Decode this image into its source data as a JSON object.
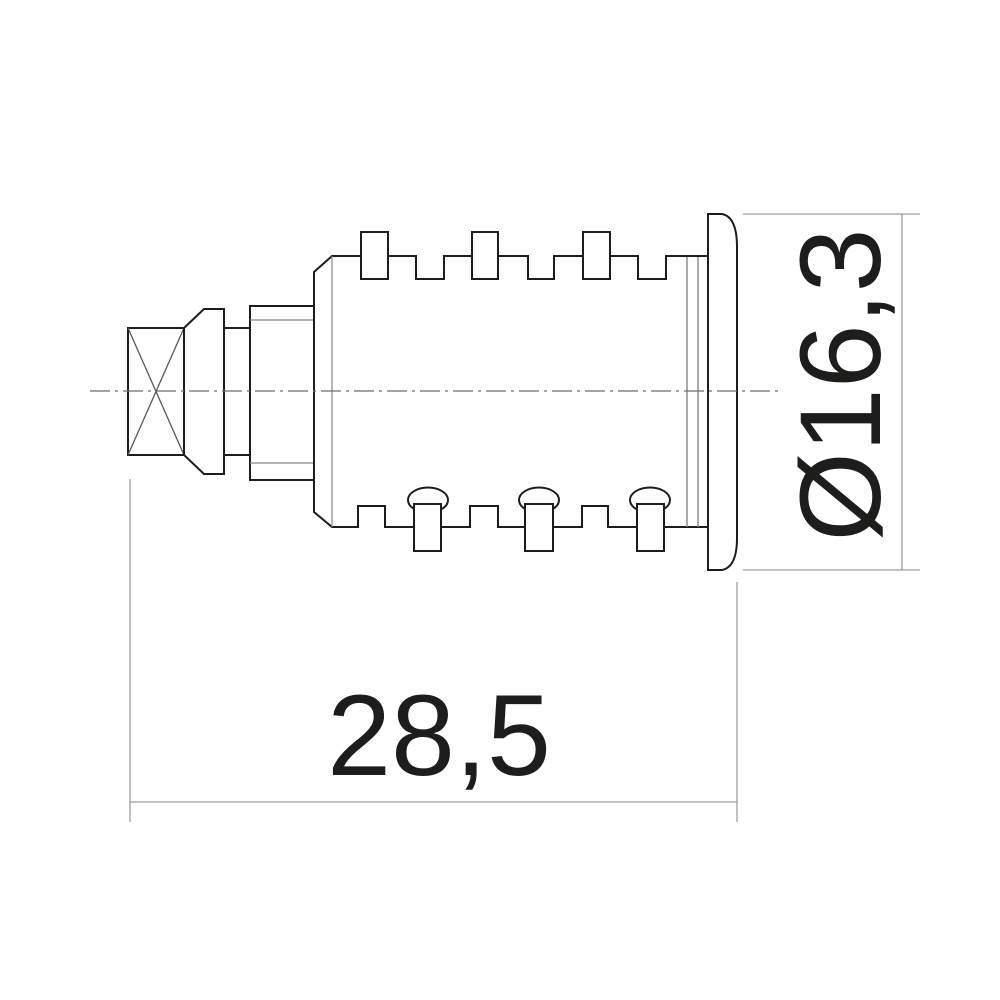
{
  "drawing": {
    "kind": "lock-cylinder-side-view",
    "dimensions": {
      "overall_length": "28,5",
      "flange_diameter": "Ø16,3"
    },
    "colors": {
      "outline": "#1d1d1b",
      "inner_edge": "#878787",
      "diagonal": "#575756",
      "centerline": "#6e6e6d",
      "dimension_lines": "#9d9d9c",
      "text": "#1d1d1b",
      "background": "#ffffff"
    }
  }
}
